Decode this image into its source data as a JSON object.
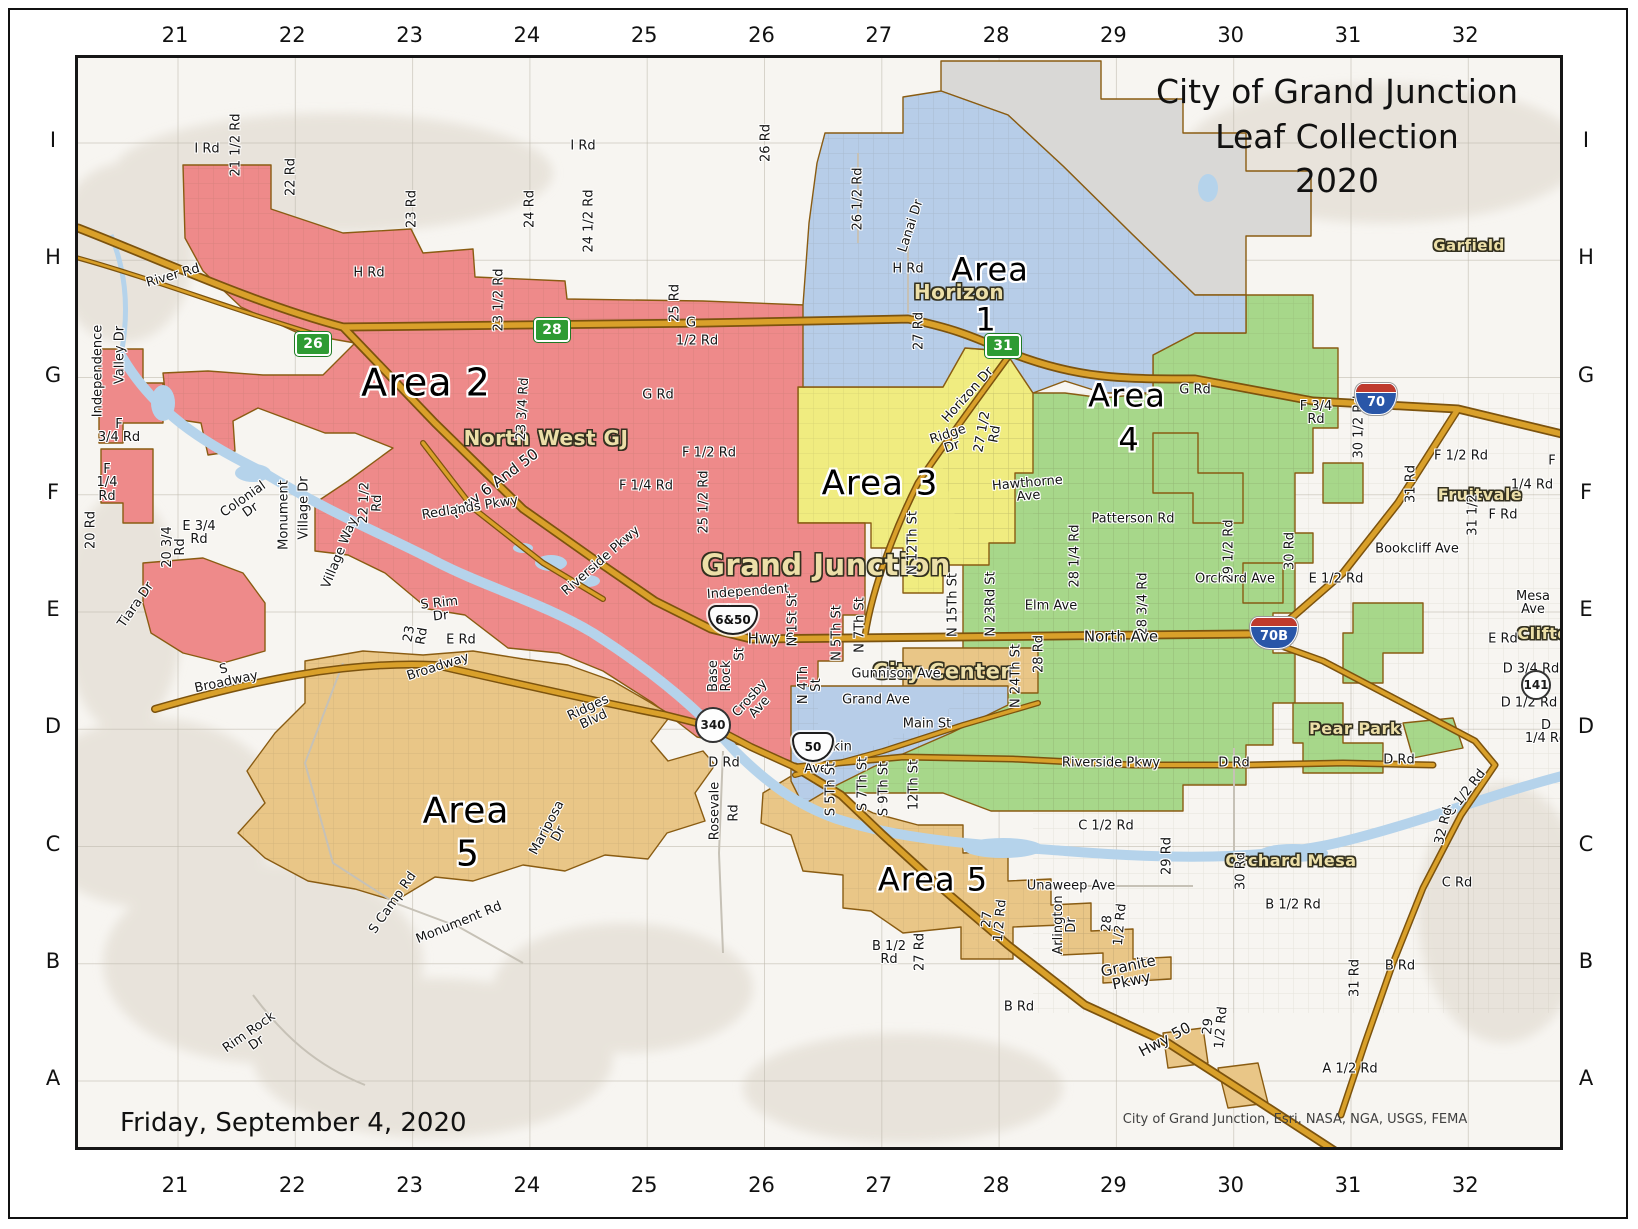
{
  "map_title": {
    "line1": "City of Grand Junction",
    "line2": "Leaf Collection",
    "line3": "2020"
  },
  "date_label": "Friday, September 4, 2020",
  "attribution": "City of Grand Junction, Esri, NASA, NGA, USGS, FEMA",
  "grid": {
    "columns": [
      "21",
      "22",
      "23",
      "24",
      "25",
      "26",
      "27",
      "28",
      "29",
      "30",
      "31",
      "32"
    ],
    "rows": [
      "I",
      "H",
      "G",
      "F",
      "E",
      "D",
      "C",
      "B",
      "A"
    ]
  },
  "colors": {
    "area1": "#b7cde8",
    "area2": "#ee8a8a",
    "area3": "#f0ec80",
    "area4": "#a7d78a",
    "area5": "#e9c687",
    "outside": "#d9d8d6",
    "water": "#b5d3eb",
    "road": "#d9a02a",
    "roadCasing": "#7c530e",
    "terrain": "#f7f5f1"
  },
  "areas": [
    {
      "name": "Area 1",
      "color": "#b7cde8",
      "place": "Horizon"
    },
    {
      "name": "Area 2",
      "color": "#ee8a8a",
      "place": "North West GJ"
    },
    {
      "name": "Area 3",
      "color": "#f0ec80",
      "place": ""
    },
    {
      "name": "Area 4",
      "color": "#a7d78a",
      "place": ""
    },
    {
      "name": "Area 5",
      "color": "#e9c687",
      "place": "Orchard Mesa / Redlands"
    }
  ],
  "map": {
    "labels": [
      {
        "t": "Area 2",
        "x": 423,
        "y": 380,
        "s": 38,
        "c": "area"
      },
      {
        "t": "Area",
        "x": 987,
        "y": 267,
        "s": 32,
        "c": "area"
      },
      {
        "t": "1",
        "x": 983,
        "y": 317,
        "s": 32,
        "c": "area"
      },
      {
        "t": "Area 3",
        "x": 877,
        "y": 481,
        "s": 34,
        "c": "area"
      },
      {
        "t": "Area",
        "x": 1124,
        "y": 393,
        "s": 32,
        "c": "area"
      },
      {
        "t": "4",
        "x": 1126,
        "y": 437,
        "s": 32,
        "c": "area"
      },
      {
        "t": "Area",
        "x": 463,
        "y": 809,
        "s": 36,
        "c": "area"
      },
      {
        "t": "5",
        "x": 465,
        "y": 852,
        "s": 36,
        "c": "area"
      },
      {
        "t": "Area 5",
        "x": 930,
        "y": 877,
        "s": 32,
        "c": "area"
      },
      {
        "t": "Horizon",
        "x": 956,
        "y": 289,
        "s": 20,
        "c": "place"
      },
      {
        "t": "North West GJ",
        "x": 543,
        "y": 435,
        "s": 20,
        "c": "place"
      },
      {
        "t": "Grand Junction",
        "x": 823,
        "y": 563,
        "s": 29,
        "c": "place"
      },
      {
        "t": "City Center",
        "x": 939,
        "y": 669,
        "s": 21,
        "c": "place"
      },
      {
        "t": "Fruitvale",
        "x": 1477,
        "y": 492,
        "s": 16,
        "c": "place"
      },
      {
        "t": "Clifton",
        "x": 1546,
        "y": 631,
        "s": 16,
        "c": "place"
      },
      {
        "t": "Garfield",
        "x": 1466,
        "y": 243,
        "s": 15,
        "c": "place"
      },
      {
        "t": "Pear Park",
        "x": 1352,
        "y": 726,
        "s": 16,
        "c": "place"
      },
      {
        "t": "Orchard Mesa",
        "x": 1288,
        "y": 858,
        "s": 16,
        "c": "place"
      },
      {
        "t": "I Rd",
        "x": 204,
        "y": 146
      },
      {
        "t": "21 1/2 Rd",
        "x": 233,
        "y": 142,
        "r": -90
      },
      {
        "t": "22 Rd",
        "x": 288,
        "y": 174,
        "r": -90
      },
      {
        "t": "23 Rd",
        "x": 409,
        "y": 206,
        "r": -90
      },
      {
        "t": "24 Rd",
        "x": 527,
        "y": 206,
        "r": -90
      },
      {
        "t": "24 1/2 Rd",
        "x": 586,
        "y": 218,
        "r": -90
      },
      {
        "t": "I Rd",
        "x": 580,
        "y": 143
      },
      {
        "t": "26 Rd",
        "x": 763,
        "y": 140,
        "r": -90
      },
      {
        "t": "26 1/2 Rd",
        "x": 855,
        "y": 196,
        "r": -90
      },
      {
        "t": "Lanai Dr",
        "x": 908,
        "y": 223,
        "r": -72
      },
      {
        "t": "H Rd",
        "x": 905,
        "y": 266
      },
      {
        "t": "H Rd",
        "x": 366,
        "y": 270
      },
      {
        "t": "River Rd",
        "x": 170,
        "y": 273,
        "r": -16
      },
      {
        "t": "27 Rd",
        "x": 916,
        "y": 328,
        "r": -90
      },
      {
        "t": "25 Rd",
        "x": 672,
        "y": 300,
        "r": -90
      },
      {
        "t": "23 1/2 Rd",
        "x": 496,
        "y": 297,
        "r": -90
      },
      {
        "t": "G",
        "x": 688,
        "y": 320
      },
      {
        "t": "1/2 Rd",
        "x": 694,
        "y": 338
      },
      {
        "t": "G Rd",
        "x": 655,
        "y": 392
      },
      {
        "t": "G Rd",
        "x": 1192,
        "y": 387
      },
      {
        "t": "Horizon Dr",
        "x": 965,
        "y": 392,
        "r": -48
      },
      {
        "t": "Ridge\nDr",
        "x": 947,
        "y": 438,
        "r": -18
      },
      {
        "t": "27 1/2\nRd",
        "x": 986,
        "y": 430,
        "r": -80
      },
      {
        "t": "Hawthorne\nAve",
        "x": 1025,
        "y": 487,
        "r": -5
      },
      {
        "t": "23 3/4 Rd",
        "x": 520,
        "y": 406,
        "r": -87
      },
      {
        "t": "Hwy 6 And 50",
        "x": 492,
        "y": 481,
        "r": -37,
        "s": 15
      },
      {
        "t": "F 1/2 Rd",
        "x": 706,
        "y": 450
      },
      {
        "t": "F 1/4 Rd",
        "x": 643,
        "y": 483
      },
      {
        "t": "25 1/2 Rd",
        "x": 701,
        "y": 499,
        "r": -90
      },
      {
        "t": "F 3/4\nRd",
        "x": 1313,
        "y": 410
      },
      {
        "t": "30 1/2 Rd",
        "x": 1356,
        "y": 424,
        "r": -90
      },
      {
        "t": "F 1/2 Rd",
        "x": 1458,
        "y": 453
      },
      {
        "t": "F",
        "x": 1549,
        "y": 458
      },
      {
        "t": "1/4 Rd",
        "x": 1529,
        "y": 482
      },
      {
        "t": "F Rd",
        "x": 1500,
        "y": 512
      },
      {
        "t": "31 Rd",
        "x": 1408,
        "y": 481,
        "r": -90
      },
      {
        "t": "31 1/2",
        "x": 1470,
        "y": 512,
        "r": -90
      },
      {
        "t": "Bookcliff Ave",
        "x": 1414,
        "y": 546
      },
      {
        "t": "E 1/2 Rd",
        "x": 1333,
        "y": 576
      },
      {
        "t": "Patterson Rd",
        "x": 1130,
        "y": 516
      },
      {
        "t": "Orchard Ave",
        "x": 1232,
        "y": 576
      },
      {
        "t": "29 1/2 Rd",
        "x": 1226,
        "y": 548,
        "r": -90
      },
      {
        "t": "30 Rd",
        "x": 1287,
        "y": 548,
        "r": -90
      },
      {
        "t": "28 1/4 Rd",
        "x": 1072,
        "y": 553,
        "r": -90
      },
      {
        "t": "28 3/4 Rd",
        "x": 1140,
        "y": 601,
        "r": -90
      },
      {
        "t": "Elm Ave",
        "x": 1048,
        "y": 603
      },
      {
        "t": "North Ave",
        "x": 1118,
        "y": 634,
        "s": 15
      },
      {
        "t": "Mesa\nAve",
        "x": 1530,
        "y": 600
      },
      {
        "t": "E Rd",
        "x": 1500,
        "y": 636
      },
      {
        "t": "D 3/4 Rd",
        "x": 1528,
        "y": 666
      },
      {
        "t": "D 1/2 Rd",
        "x": 1526,
        "y": 700
      },
      {
        "t": "D\n1/4 Rd",
        "x": 1543,
        "y": 729
      },
      {
        "t": "D Rd",
        "x": 1396,
        "y": 757
      },
      {
        "t": "D Rd",
        "x": 1231,
        "y": 760
      },
      {
        "t": "Riverside Pkwy",
        "x": 1108,
        "y": 760
      },
      {
        "t": "C 1/2 Rd",
        "x": 1103,
        "y": 823
      },
      {
        "t": "29 Rd",
        "x": 1164,
        "y": 853,
        "r": -90
      },
      {
        "t": "C Rd",
        "x": 1454,
        "y": 880
      },
      {
        "t": "C 1/2 Rd",
        "x": 1463,
        "y": 790,
        "r": -52
      },
      {
        "t": "32 Rd",
        "x": 1441,
        "y": 823,
        "r": -76
      },
      {
        "t": "30 Rd",
        "x": 1238,
        "y": 868,
        "r": -90
      },
      {
        "t": "B 1/2 Rd",
        "x": 1290,
        "y": 902
      },
      {
        "t": "31 Rd",
        "x": 1352,
        "y": 975,
        "r": -90
      },
      {
        "t": "B Rd",
        "x": 1397,
        "y": 963
      },
      {
        "t": "29\n1/2 Rd",
        "x": 1212,
        "y": 1024,
        "r": -85
      },
      {
        "t": "A 1/2 Rd",
        "x": 1347,
        "y": 1066
      },
      {
        "t": "Hwy 50",
        "x": 1162,
        "y": 1037,
        "r": -28,
        "s": 15
      },
      {
        "t": "B Rd",
        "x": 1016,
        "y": 1004
      },
      {
        "t": "Granite\nPkwy",
        "x": 1127,
        "y": 971,
        "r": -12,
        "s": 15
      },
      {
        "t": "28\n1/2 Rd",
        "x": 1111,
        "y": 921,
        "r": -85
      },
      {
        "t": "Arlington\nDr",
        "x": 1062,
        "y": 922,
        "r": -90
      },
      {
        "t": "Unaweep Ave",
        "x": 1068,
        "y": 883
      },
      {
        "t": "27\n1/2 Rd",
        "x": 991,
        "y": 917,
        "r": -85
      },
      {
        "t": "B 1/2\nRd",
        "x": 886,
        "y": 950
      },
      {
        "t": "27 Rd",
        "x": 917,
        "y": 949,
        "r": -90
      },
      {
        "t": "Independent",
        "x": 745,
        "y": 589,
        "r": -4
      },
      {
        "t": "Ave",
        "x": 733,
        "y": 608
      },
      {
        "t": "Hwy 6",
        "x": 768,
        "y": 636,
        "s": 15
      },
      {
        "t": "N 1St St",
        "x": 790,
        "y": 617,
        "r": -90
      },
      {
        "t": "N 5Th St",
        "x": 834,
        "y": 630,
        "r": -90
      },
      {
        "t": "N 7Th St",
        "x": 857,
        "y": 622,
        "r": -90
      },
      {
        "t": "N 12Th St",
        "x": 910,
        "y": 540,
        "r": -90
      },
      {
        "t": "N 15Th St",
        "x": 950,
        "y": 602,
        "r": -90
      },
      {
        "t": "N 23Rd St",
        "x": 988,
        "y": 601,
        "r": -90
      },
      {
        "t": "Base\nRock",
        "x": 717,
        "y": 673,
        "r": -90
      },
      {
        "t": "St",
        "x": 737,
        "y": 651,
        "r": -90
      },
      {
        "t": "Crosby\nAve",
        "x": 752,
        "y": 700,
        "r": -48
      },
      {
        "t": "N 4Th\nSt",
        "x": 807,
        "y": 682,
        "r": -90
      },
      {
        "t": "Gunnison Ave",
        "x": 893,
        "y": 671
      },
      {
        "t": "Grand Ave",
        "x": 873,
        "y": 697
      },
      {
        "t": "Main St",
        "x": 924,
        "y": 721
      },
      {
        "t": "Pitkin",
        "x": 831,
        "y": 744
      },
      {
        "t": "Ave",
        "x": 813,
        "y": 766
      },
      {
        "t": "S 5Th St",
        "x": 828,
        "y": 786,
        "r": -90
      },
      {
        "t": "S 7Th St",
        "x": 860,
        "y": 781,
        "r": -90
      },
      {
        "t": "S 9Th St",
        "x": 881,
        "y": 786,
        "r": -90
      },
      {
        "t": "12Th St",
        "x": 911,
        "y": 782,
        "r": -90
      },
      {
        "t": "N 24Th St",
        "x": 1013,
        "y": 673,
        "r": -90
      },
      {
        "t": "28 Rd",
        "x": 1036,
        "y": 651,
        "r": -90
      },
      {
        "t": "Riverside Pkwy",
        "x": 598,
        "y": 558,
        "r": -41
      },
      {
        "t": "Redlands Pkwy",
        "x": 467,
        "y": 505,
        "r": -9
      },
      {
        "t": "22 1/2\nRd",
        "x": 368,
        "y": 500,
        "r": -88
      },
      {
        "t": "23\nRd",
        "x": 413,
        "y": 632,
        "r": -80
      },
      {
        "t": "E Rd",
        "x": 458,
        "y": 637
      },
      {
        "t": "S Rim\nDr",
        "x": 437,
        "y": 607,
        "r": -6
      },
      {
        "t": "Broadway",
        "x": 435,
        "y": 664,
        "r": -18
      },
      {
        "t": "S\nBroadway",
        "x": 222,
        "y": 673,
        "r": -12
      },
      {
        "t": "Ridges\nBlvd",
        "x": 588,
        "y": 711,
        "r": -25
      },
      {
        "t": "D Rd",
        "x": 721,
        "y": 760
      },
      {
        "t": "Rosevale",
        "x": 712,
        "y": 808,
        "r": -90
      },
      {
        "t": "Rd",
        "x": 731,
        "y": 810,
        "r": -90
      },
      {
        "t": "Mariposa\nDr",
        "x": 550,
        "y": 828,
        "r": -62
      },
      {
        "t": "S Camp Rd",
        "x": 390,
        "y": 900,
        "r": -55
      },
      {
        "t": "Monument Rd",
        "x": 456,
        "y": 920,
        "r": -22
      },
      {
        "t": "Rim Rock\nDr",
        "x": 250,
        "y": 1035,
        "r": -35
      },
      {
        "t": "Independence",
        "x": 95,
        "y": 368,
        "r": -90
      },
      {
        "t": "Valley Dr",
        "x": 117,
        "y": 352,
        "r": -90
      },
      {
        "t": "F\n3/4 Rd",
        "x": 116,
        "y": 428
      },
      {
        "t": "F\n1/4\nRd",
        "x": 104,
        "y": 480
      },
      {
        "t": "20 Rd",
        "x": 88,
        "y": 527,
        "r": -90
      },
      {
        "t": "20 3/4\nRd",
        "x": 171,
        "y": 544,
        "r": -90
      },
      {
        "t": "E 3/4\nRd",
        "x": 196,
        "y": 530
      },
      {
        "t": "Colonial\nDr",
        "x": 244,
        "y": 502,
        "r": -35
      },
      {
        "t": "Monument",
        "x": 281,
        "y": 512,
        "r": -90
      },
      {
        "t": "Village Dr",
        "x": 301,
        "y": 505,
        "r": -90
      },
      {
        "t": "Village Way",
        "x": 337,
        "y": 550,
        "r": -68
      },
      {
        "t": "Tiara Dr",
        "x": 133,
        "y": 602,
        "r": -55
      }
    ],
    "shields": [
      {
        "type": "green",
        "label": "26",
        "x": 310,
        "y": 341
      },
      {
        "type": "green",
        "label": "28",
        "x": 549,
        "y": 327
      },
      {
        "type": "green",
        "label": "31",
        "x": 1000,
        "y": 343
      },
      {
        "type": "interstate",
        "label": "70",
        "x": 1373,
        "y": 396
      },
      {
        "type": "interstate",
        "label": "70B",
        "x": 1271,
        "y": 630,
        "w": 48
      },
      {
        "type": "us",
        "label": "6&50",
        "x": 730,
        "y": 617,
        "w": 50
      },
      {
        "type": "us",
        "label": "50",
        "x": 810,
        "y": 744
      },
      {
        "type": "circle",
        "label": "340",
        "x": 710,
        "y": 722,
        "w": 36
      },
      {
        "type": "circle",
        "label": "141",
        "x": 1533,
        "y": 682,
        "w": 30
      }
    ]
  }
}
